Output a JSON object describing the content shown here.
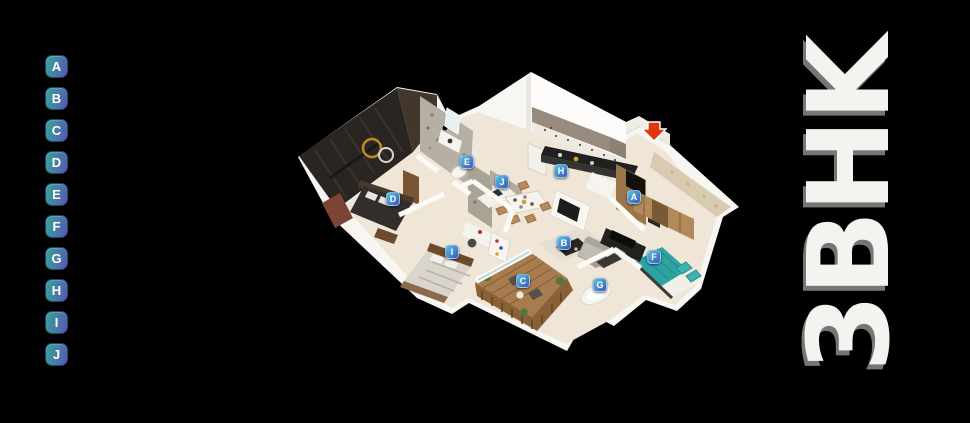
{
  "title": {
    "text": "3BHK"
  },
  "legend": {
    "letters": [
      "A",
      "B",
      "C",
      "D",
      "E",
      "F",
      "G",
      "H",
      "I",
      "J"
    ]
  },
  "floor_plan": {
    "markers": [
      {
        "label": "A",
        "x": 634,
        "y": 197
      },
      {
        "label": "B",
        "x": 564,
        "y": 243
      },
      {
        "label": "C",
        "x": 523,
        "y": 281
      },
      {
        "label": "D",
        "x": 393,
        "y": 199
      },
      {
        "label": "E",
        "x": 467,
        "y": 162
      },
      {
        "label": "F",
        "x": 654,
        "y": 257
      },
      {
        "label": "G",
        "x": 600,
        "y": 285
      },
      {
        "label": "H",
        "x": 561,
        "y": 171
      },
      {
        "label": "I",
        "x": 452,
        "y": 252
      },
      {
        "label": "J",
        "x": 502,
        "y": 182
      }
    ],
    "entrance_arrow": {
      "direction": "down",
      "color": "#e2340e"
    }
  },
  "colors": {
    "bg": "#000000",
    "badge_g1": "#30a795",
    "badge_g2": "#5b55b6",
    "marker_g1": "#4ec9dd",
    "marker_g2": "#4152bd",
    "title_col": "#f5f3f0"
  }
}
